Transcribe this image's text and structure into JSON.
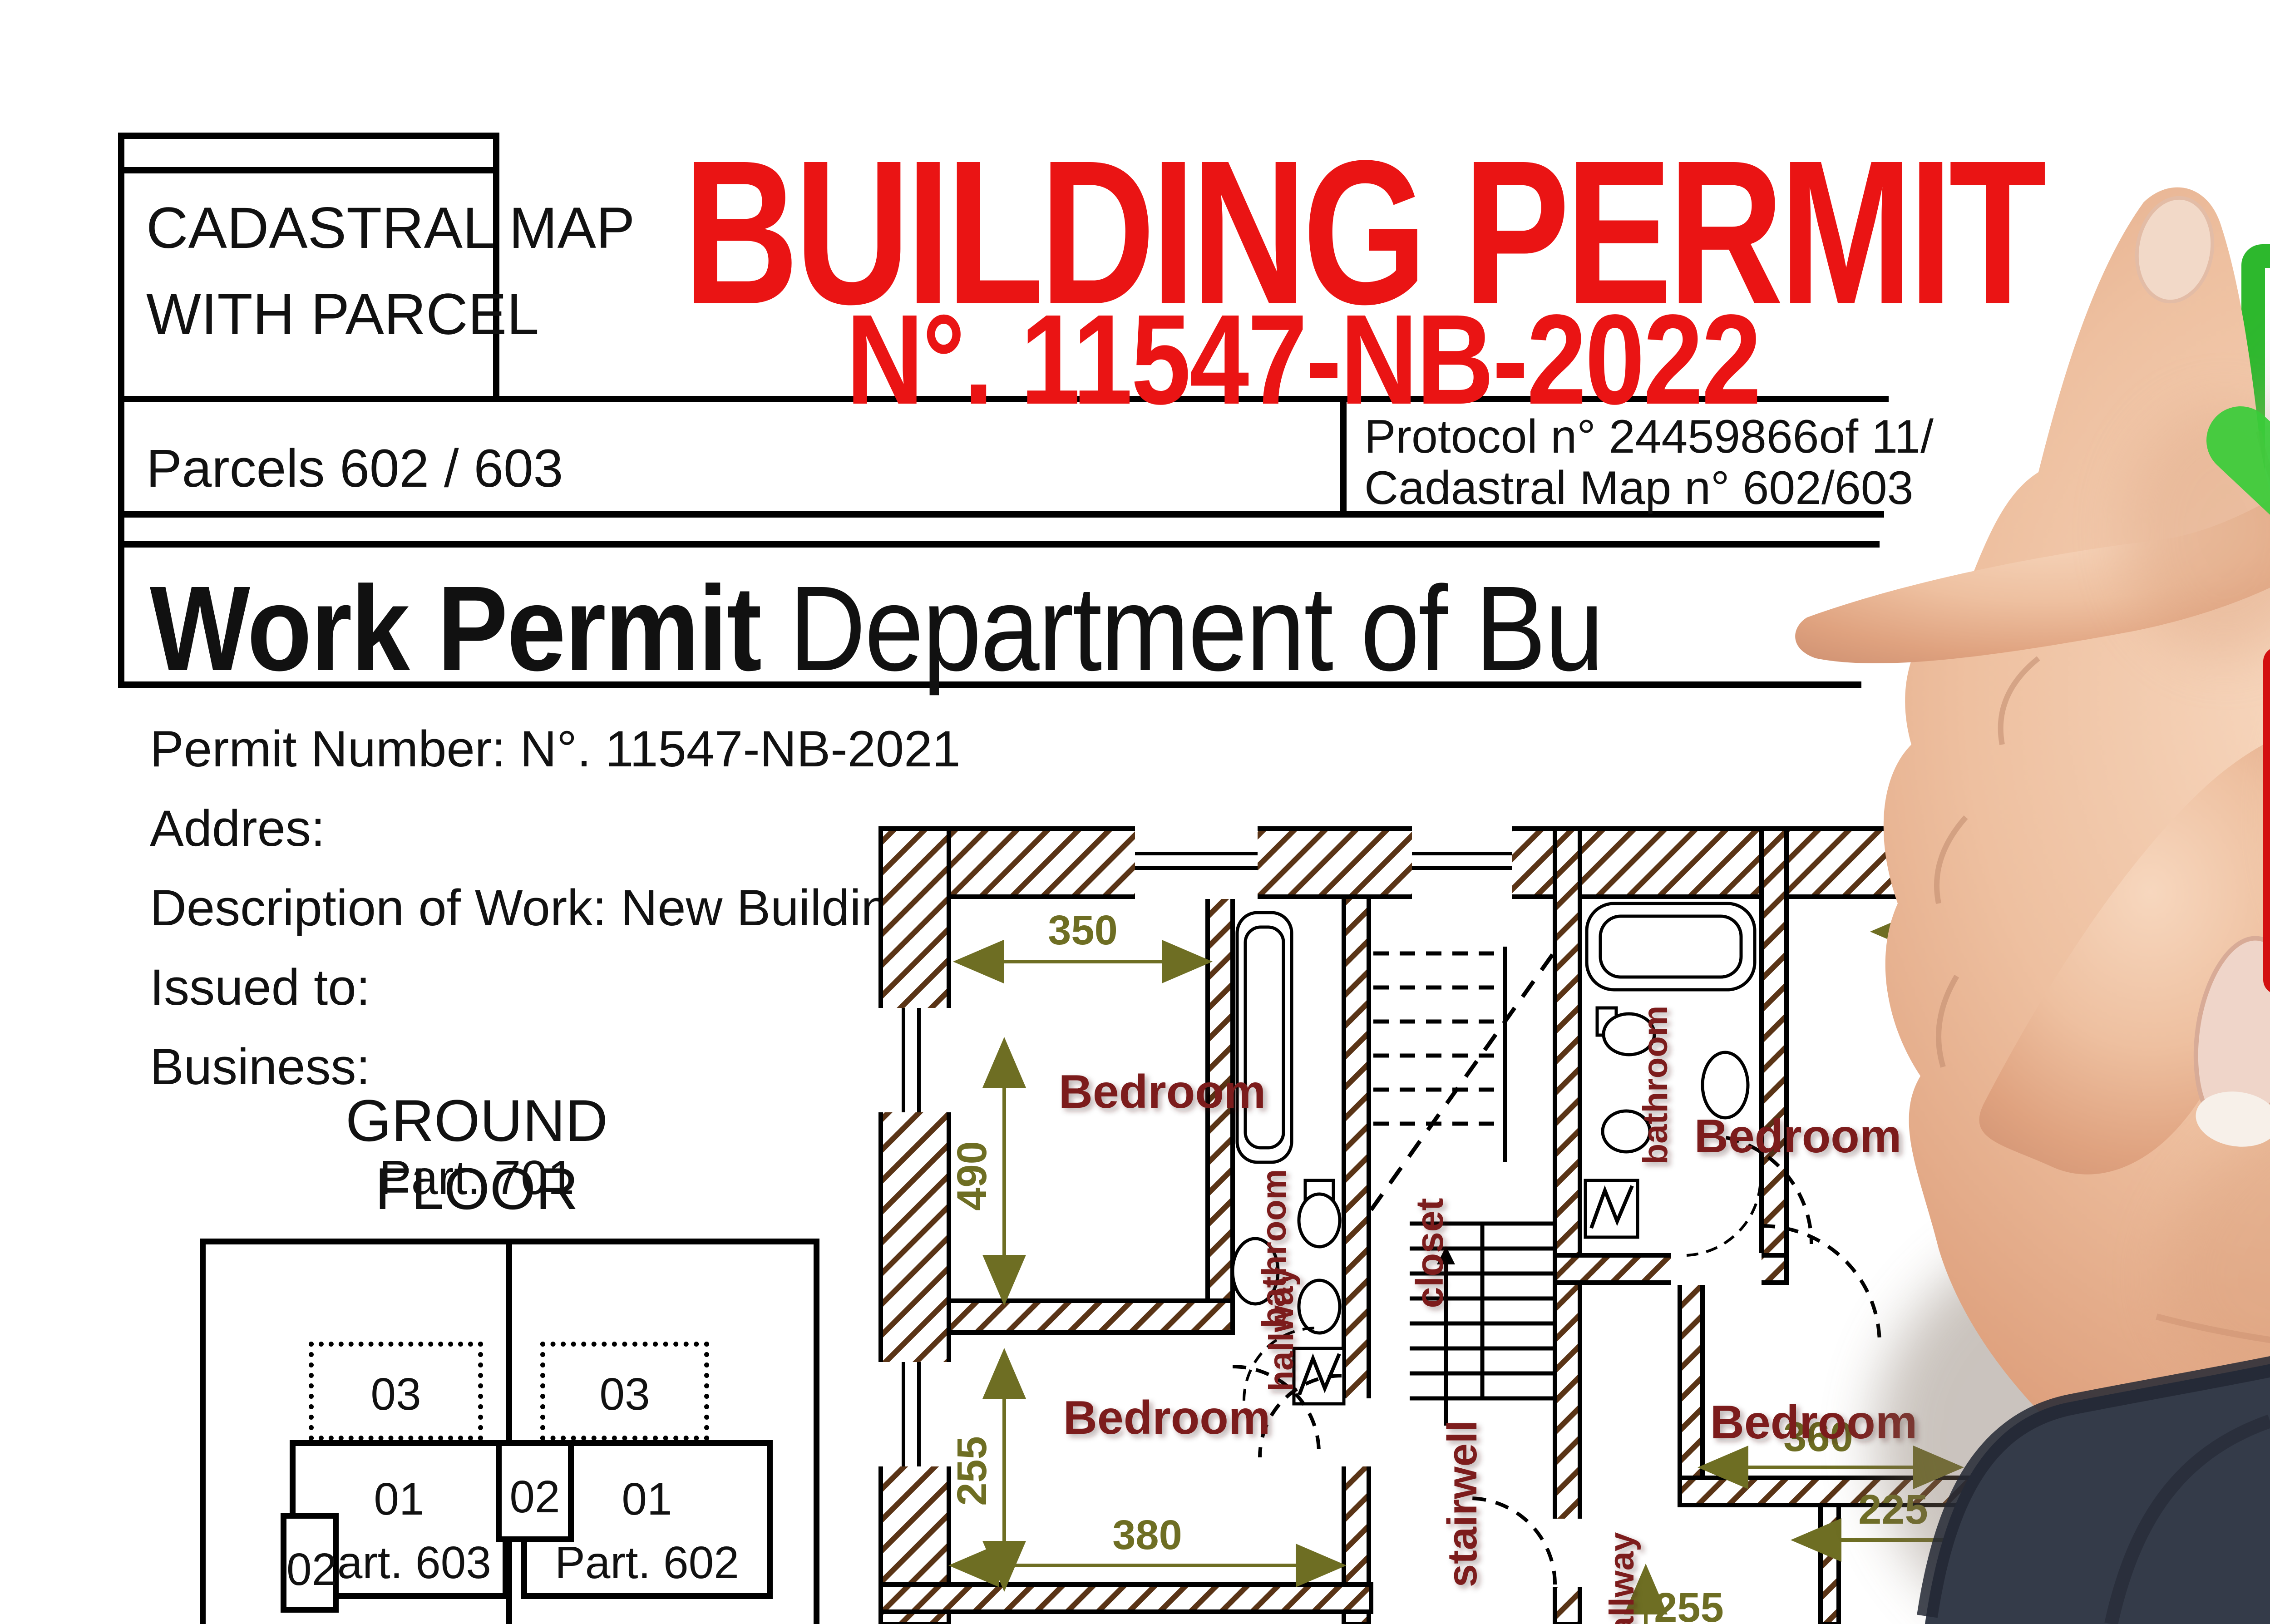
{
  "header": {
    "cadastral_line1": "CADASTRAL MAP",
    "cadastral_line2": "WITH PARCEL",
    "title": "BUILDING PERMIT",
    "permit_no": "N°. 11547-NB-2022",
    "parcels": "Parcels 602 / 603",
    "protocol": "Protocol n° 24459866",
    "protocol_of": "of 11/",
    "cadastral_map_no": "Cadastral Map n° 602/603"
  },
  "work_permit": {
    "heading_bold": "Work Permit",
    "heading_rest": " Department of Bu",
    "permit_number": "Permit Number: N°. 11547-NB-2021",
    "address": "Addres:",
    "description": "Description of Work: New Building",
    "issued_to": "Issued to:",
    "business": "Business:"
  },
  "ground_floor": {
    "title": "GROUND FLOOR",
    "part": "Part. 701"
  },
  "parcel_map": {
    "p03_left": "03",
    "p03_right": "03",
    "p01_left": "01",
    "part_left": "Part. 603",
    "p01_right": "01",
    "part_right": "Part. 602",
    "p02_left": "02",
    "p02_mid": "02"
  },
  "floor_plan": {
    "bedroom_tl": "Bedroom",
    "bedroom_bl": "Bedroom",
    "bedroom_tr": "Bedroom",
    "bedroom_br": "Bedroom",
    "bathroom_left": "bathroom",
    "bathroom_right": "bathroom",
    "closet": "closet",
    "stairwell": "stairwell",
    "hallway_left": "hallway",
    "hallway_right": "hallway",
    "dim_350": "350",
    "dim_490": "490",
    "dim_255": "255",
    "dim_380": "380",
    "dim_360": "360",
    "dim_225": "225",
    "dim_255_bottom": "255"
  },
  "stamps": {
    "approved": "APPROVED",
    "approved_ghost": "APPROVED",
    "rejected": "REJECTED"
  },
  "colors": {
    "title_red": "#ea1414",
    "approved_green": "#2ed32e",
    "approved_box_green": "#2db82d",
    "rejected_red": "#ee1212",
    "rejected_box_red": "#d31010",
    "room_label": "#7b1c1c",
    "dimension_olive": "#6e6e23",
    "wall_hatch_brown": "#5a3416",
    "sleeve_navy": "#3a4150"
  }
}
